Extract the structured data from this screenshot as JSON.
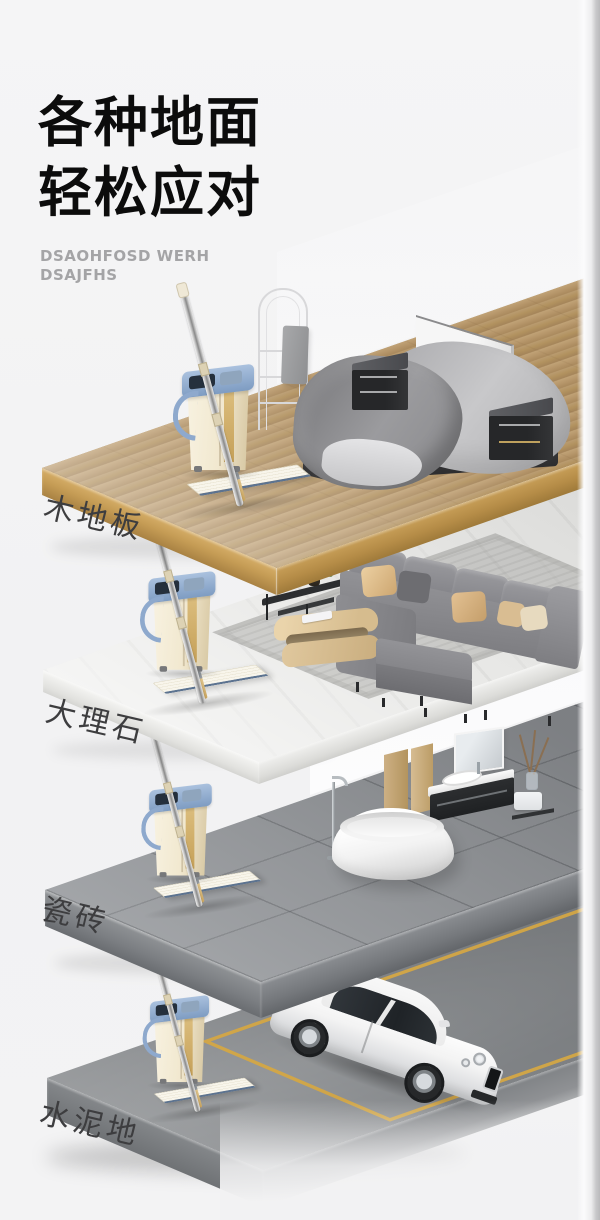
{
  "page": {
    "background_color": "#f2f2f3",
    "right_wall_strip_color": "#b9b9bb"
  },
  "header": {
    "title_line1": "各种地面",
    "title_line2": "轻松应对",
    "subtitle_line1": "DSAOHFOSD WERH",
    "subtitle_line2": "DSAJFHS",
    "title_color": "#0c0c0c",
    "subtitle_color": "#a4a4a6"
  },
  "floors": [
    {
      "label": "木地板",
      "material": "wood-floor",
      "scene": "bedroom",
      "surface_color": "#b5976a"
    },
    {
      "label": "大理石",
      "material": "marble",
      "scene": "living-room",
      "surface_color": "#e9e9e7"
    },
    {
      "label": "瓷砖",
      "material": "ceramic-tile",
      "scene": "bathroom",
      "surface_color": "#8e9195"
    },
    {
      "label": "水泥地",
      "material": "cement",
      "scene": "garage",
      "surface_color": "#7d8083",
      "parking_line_color": "#d2a544"
    }
  ],
  "product": {
    "name": "flat-squeeze-mop-with-bucket",
    "bucket_body_color": "#f1e8cf",
    "bucket_rim_color": "#8ea9cd",
    "pole_color": "#9b9b9d",
    "mop_pad_color": "#f6f3e9"
  }
}
